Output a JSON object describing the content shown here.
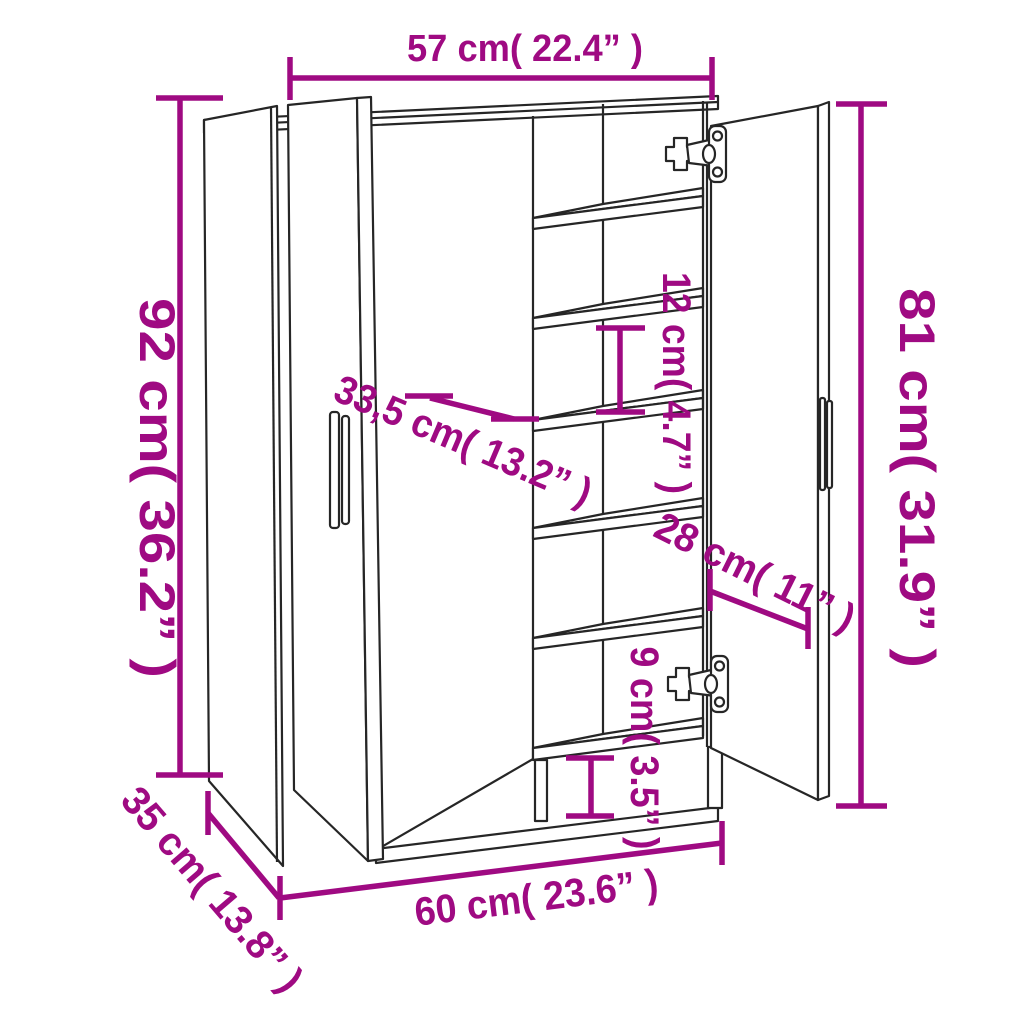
{
  "diagram": {
    "dimensions": {
      "top_width": "57 cm( 22.4” )",
      "left_height": "92 cm( 36.2” )",
      "right_height": "81 cm( 31.9” )",
      "shelf_depth": "33,5 cm( 13.2” )",
      "shelf_gap": "12 cm( 4.7” )",
      "door_width": "28 cm( 11” )",
      "base_height": "9 cm( 3.5” )",
      "bottom_width": "60 cm( 23.6” )",
      "bottom_depth": "35 cm( 13.8” )"
    },
    "colors": {
      "dimension_accent": "#9F0A82",
      "outline": "#262626",
      "background": "#FFFFFF"
    }
  }
}
